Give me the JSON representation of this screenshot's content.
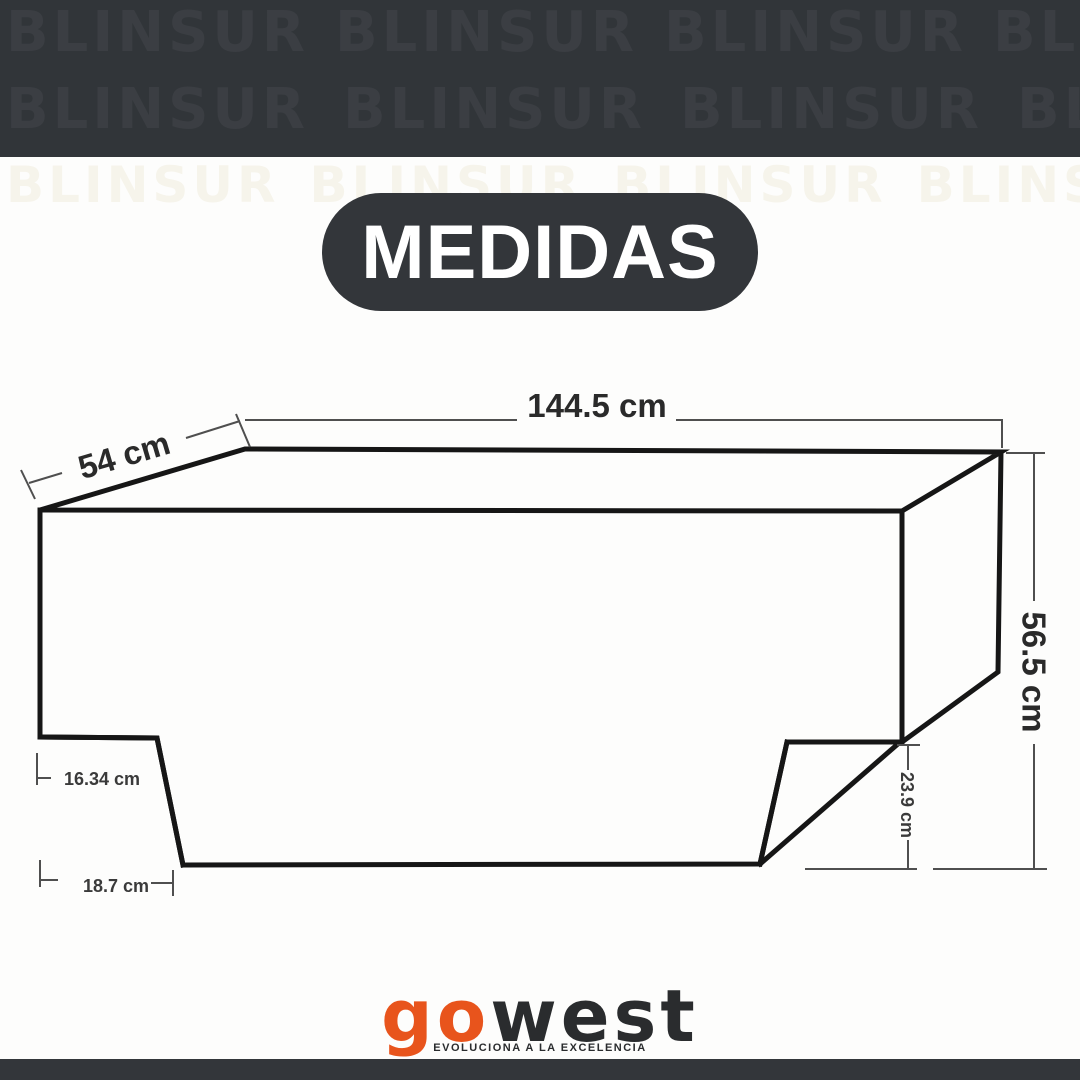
{
  "brand_watermark": "BLINSUR",
  "header": {
    "title": "MEDIDAS"
  },
  "diagram": {
    "type": "dimension-drawing",
    "dimensions": {
      "top_width": "144.5 cm",
      "side_depth": "54 cm",
      "height": "56.5 cm",
      "left_step": "16.34 cm",
      "left_bottom": "18.7 cm",
      "right_drop": "23.9 cm"
    }
  },
  "footer": {
    "logo_primary": "go",
    "logo_secondary": "west",
    "tagline": "EVOLUCIONA A LA EXCELENCIA"
  },
  "colors": {
    "band": "#313539",
    "watermark_text": "#3b3e43",
    "pill": "#33363a",
    "pill_text": "#ffffff",
    "background": "#fdfdfc",
    "object_line": "#161616",
    "dimension_line": "#4f4f4f",
    "logo_primary": "#e8541c",
    "logo_secondary": "#2a2c2e"
  }
}
